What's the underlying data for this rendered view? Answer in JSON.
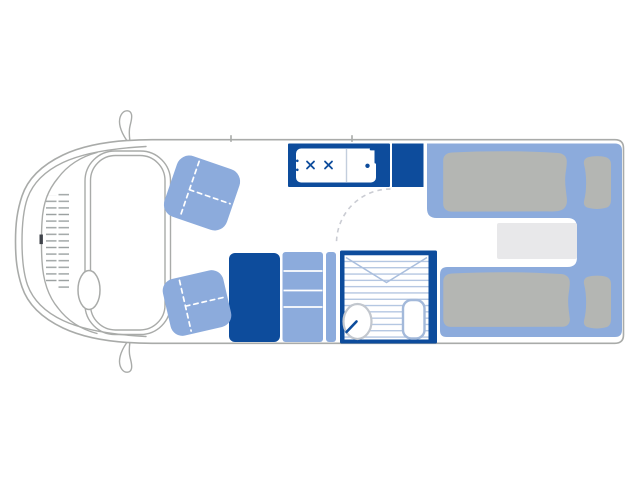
{
  "image": {
    "type": "motorhome floor plan, top-down line drawing, no visible text",
    "background": "#ffffff"
  },
  "colors": {
    "accent": "#0d4c9c",
    "furniture": "#8cabdc",
    "mattress": "#b4b6b3",
    "step": "#e8e8ea",
    "stripe": "#a9bedd",
    "outline": "#a9aba9",
    "divider": "#c3cedd",
    "dash": "#caccd3",
    "toilet_stroke": "#a3b9da",
    "basin_stroke": "#c2c7ce",
    "grille": "#9aa0a0",
    "notch": "#3f434a",
    "seat_seam": "#ffffff",
    "white": "#ffffff"
  },
  "components": {
    "vehicle": "van body outline with cab, two wing mirrors, windscreen band, grille, steering wheel",
    "seats": [
      "front swivel seat (top)",
      "front swivel seat (bottom)"
    ],
    "kitchen": "hob with two burners, sink with tap, worktop section",
    "wardrobe": "solid dark unit",
    "cabinet": "shelved unit with narrow side strip",
    "bathroom": "shower room: striped shower floor, envelope fold lines, washbasin with tap, toilet, dashed door swing arc",
    "rear": "two single beds on U-platform with mattresses, pillows, and a step between beds"
  }
}
